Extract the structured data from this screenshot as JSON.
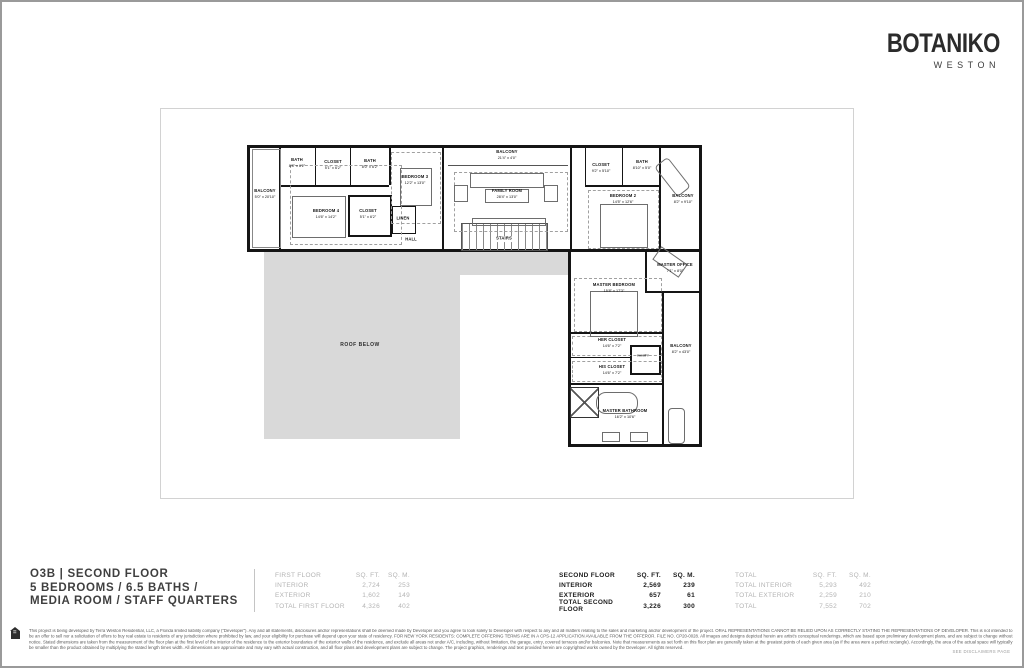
{
  "brand": {
    "name": "BOTANIKO",
    "location": "WESTON"
  },
  "title": {
    "line1": "O3B | SECOND FLOOR",
    "line2": "5 BEDROOMS / 6.5 BATHS /",
    "line3": "MEDIA ROOM / STAFF QUARTERS"
  },
  "area_tables": [
    {
      "key": "first_floor",
      "style": "muted",
      "header": {
        "label": "FIRST FLOOR",
        "sqft": "SQ. FT.",
        "sqm": "SQ. M."
      },
      "rows": [
        {
          "label": "INTERIOR",
          "sqft": "2,724",
          "sqm": "253"
        },
        {
          "label": "EXTERIOR",
          "sqft": "1,602",
          "sqm": "149"
        },
        {
          "label": "TOTAL FIRST FLOOR",
          "sqft": "4,326",
          "sqm": "402"
        }
      ]
    },
    {
      "key": "second_floor",
      "style": "strong",
      "header": {
        "label": "SECOND FLOOR",
        "sqft": "SQ. FT.",
        "sqm": "SQ. M."
      },
      "rows": [
        {
          "label": "INTERIOR",
          "sqft": "2,569",
          "sqm": "239"
        },
        {
          "label": "EXTERIOR",
          "sqft": "657",
          "sqm": "61"
        },
        {
          "label": "TOTAL SECOND FLOOR",
          "sqft": "3,226",
          "sqm": "300"
        }
      ]
    },
    {
      "key": "total",
      "style": "muted",
      "header": {
        "label": "TOTAL",
        "sqft": "SQ. FT.",
        "sqm": "SQ. M."
      },
      "rows": [
        {
          "label": "TOTAL INTERIOR",
          "sqft": "5,293",
          "sqm": "492"
        },
        {
          "label": "TOTAL EXTERIOR",
          "sqft": "2,259",
          "sqm": "210"
        },
        {
          "label": "TOTAL",
          "sqft": "7,552",
          "sqm": "702"
        }
      ]
    }
  ],
  "floorplan": {
    "roof_label": "ROOF BELOW",
    "rooms": {
      "balcony_left": {
        "name": "BALCONY",
        "dims": "5'0\" x 20'10\""
      },
      "bath_1": {
        "name": "BATH",
        "dims": "8'8\" x 6'2\""
      },
      "closet_top": {
        "name": "CLOSET",
        "dims": "5'1\" x 6'2\""
      },
      "bath_2": {
        "name": "BATH",
        "dims": "8'0\" x 6'2\""
      },
      "bedroom_4": {
        "name": "BEDROOM 4",
        "dims": "14'6\" x 14'2\""
      },
      "bedroom_3": {
        "name": "BEDROOM 3",
        "dims": "12'2\" x 13'0\""
      },
      "closet_2": {
        "name": "CLOSET",
        "dims": "5'1\" x 6'2\""
      },
      "linen": {
        "name": "LINEN"
      },
      "hall": {
        "name": "HALL"
      },
      "balcony_top": {
        "name": "BALCONY",
        "dims": "21'4\" x 4'0\""
      },
      "family_room": {
        "name": "FAMILY ROOM",
        "dims": "28'4\" x 13'0\""
      },
      "stairs": {
        "name": "STAIRS"
      },
      "closet_3": {
        "name": "CLOSET",
        "dims": "9'2\" x 5'10\""
      },
      "bath_3": {
        "name": "BATH",
        "dims": "8'10\" x 5'0\""
      },
      "bedroom_2": {
        "name": "BEDROOM 2",
        "dims": "14'5\" x 12'6\""
      },
      "balcony_2": {
        "name": "BALCONY",
        "dims": "8'2\" x 9'10\""
      },
      "master_office": {
        "name": "MASTER OFFICE",
        "dims": "7'1\" x 8'0\""
      },
      "master_bedroom": {
        "name": "MASTER BEDROOM",
        "dims": "15'8\" x 17'3\""
      },
      "her_closet": {
        "name": "HER CLOSET",
        "dims": "14'6\" x 7'2\""
      },
      "vanity": {
        "name": "VANITY"
      },
      "his_closet": {
        "name": "HIS CLOSET",
        "dims": "14'6\" x 7'2\""
      },
      "master_bathroom": {
        "name": "MASTER BATHROOM",
        "dims": "16'2\" x 10'6\""
      },
      "balcony_master": {
        "name": "BALCONY",
        "dims": "8'2\" x 43'0\""
      }
    }
  },
  "disclaimer": "This project is being developed by Terra Weston Residential, LLC, a Florida limited liability company (“Developer”). Any and all statements, disclosures and/or representations shall be deemed made by Developer and you agree to look solely to Developer with respect to any and all matters relating to the sales and marketing and/or development of the project. ORAL REPRESENTATIONS CANNOT BE RELIED UPON AS CORRECTLY STATING THE REPRESENTATIONS OF DEVELOPER. This is not intended to be an offer to sell nor a solicitation of offers to buy real estate to residents of any jurisdiction where prohibited by law, and your eligibility for purchase will depend upon your state of residency. FOR NEW YORK RESIDENTS: COMPLETE OFFERING TERMS ARE IN A CPS-12 APPLICATION AVAILABLE FROM THE OFFEROR. FILE NO. CP20-0028. All images and designs depicted herein are artist's conceptual renderings, which are based upon preliminary development plans, and are subject to change without notice. Stated dimensions are taken from the measurement of the floor plan at the first level of the interior of the residence to the exterior boundaries of the exterior walls of the residence, and exclude all areas not under A/C, including, without limitation, the garage, entry, covered terraces and/or balconies. Note that measurements as set forth on this floor plan are generally taken at the greatest points of each given area (as if the area were a perfect rectangle). Accordingly, the area of the actual space will typically be smaller than the product obtained by multiplying the stated length times width. All dimensions are approximate and may vary with actual construction, and all floor plans and development plans are subject to change. The project graphics, renderings and text provided herein are copyrighted works owned by the Developer.  All rights reserved.",
  "footer_note": "SEE DISCLAIMERS PAGE"
}
